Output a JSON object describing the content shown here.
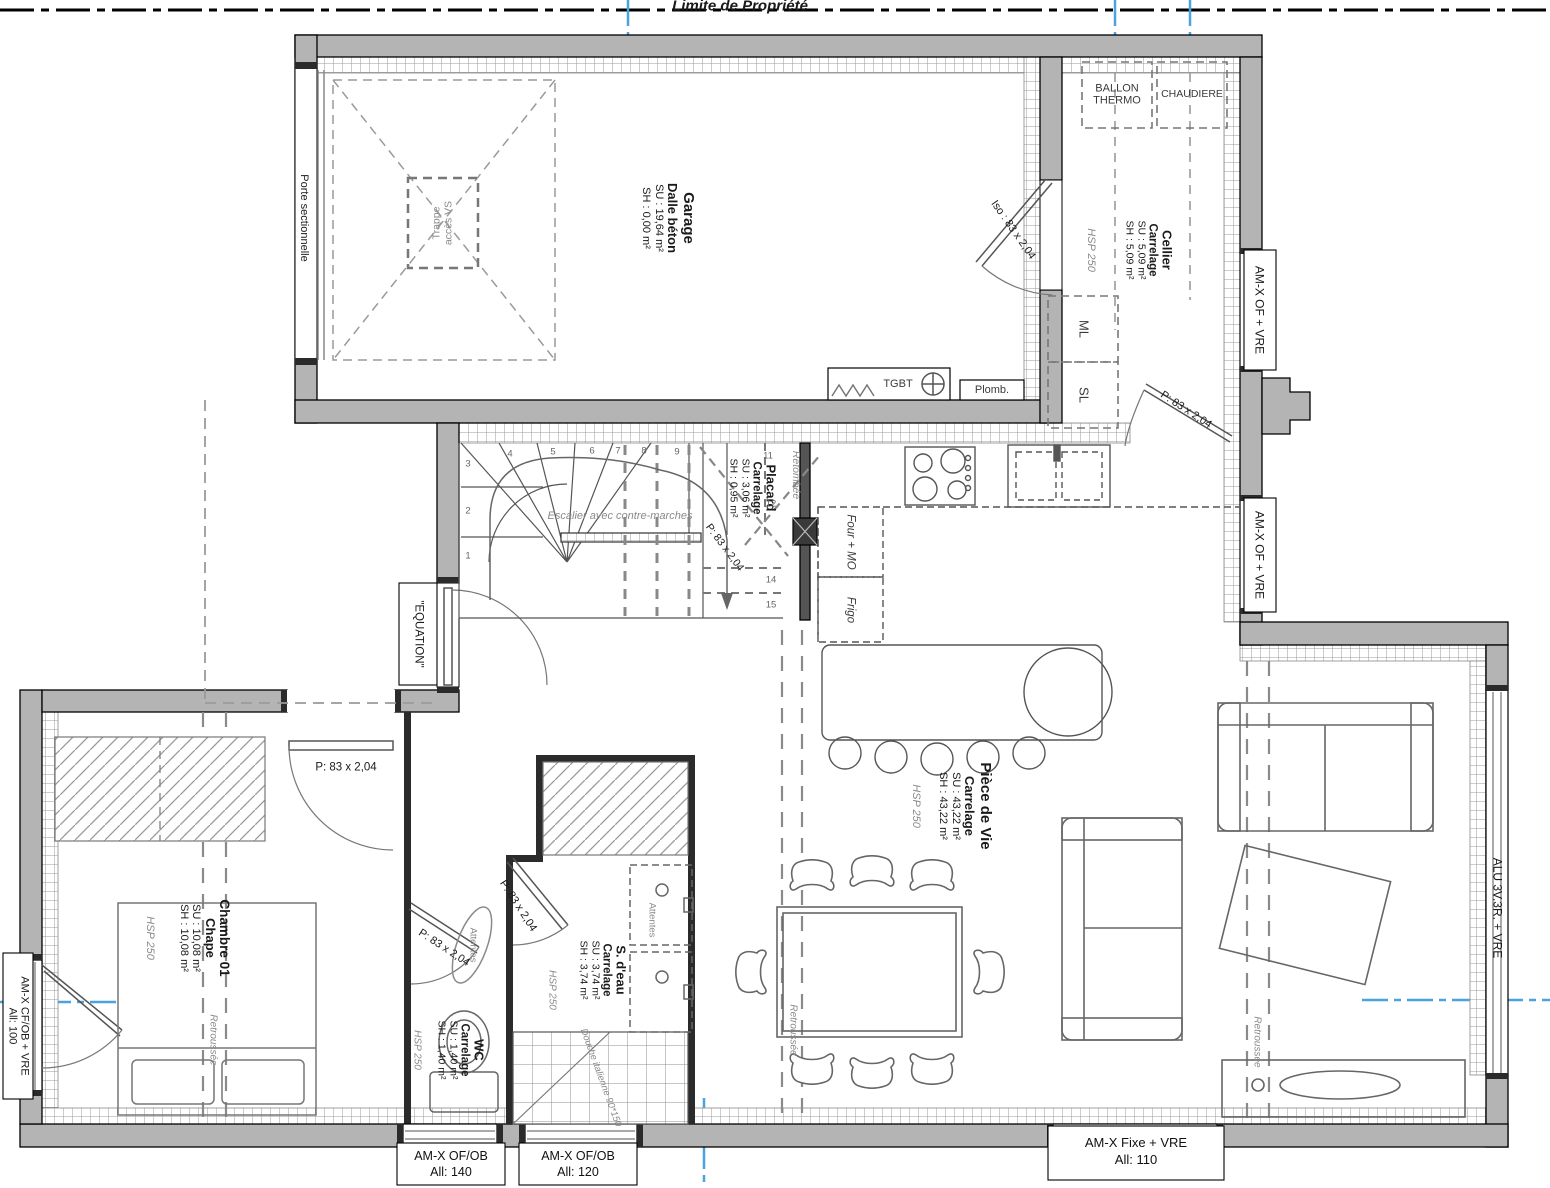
{
  "colors": {
    "wall_gray": "#b4b4b4",
    "line_black": "#1a1a1a",
    "furniture_gray": "#666666",
    "annotation_gray": "#8a8a8a",
    "axis_blue": "#4aa3df"
  },
  "property_line_label": "Limite de Propriété",
  "rooms": {
    "garage": {
      "name": "Garage",
      "floor": "Dalle béton",
      "su": "SU : 19,64 m²",
      "sh": "SH : 0,00 m²"
    },
    "cellier": {
      "name": "Cellier",
      "floor": "Carrelage",
      "su": "SU : 5,09 m²",
      "sh": "SH : 5,09 m²"
    },
    "placard": {
      "name": "Placard",
      "floor": "Carrelage",
      "su": "SU : 3,06 m²",
      "sh": "SH : 0,95 m²"
    },
    "piece_de_vie": {
      "name": "Pièce de Vie",
      "floor": "Carrelage",
      "su": "SU : 43,22 m²",
      "sh": "SH : 43,22 m²"
    },
    "chambre": {
      "name": "Chambre 01",
      "floor": "Chape",
      "su": "SU : 10,08 m²",
      "sh": "SH : 10,08 m²"
    },
    "wc": {
      "name": "WC",
      "floor": "Carrelage",
      "su": "SU : 1,40 m²",
      "sh": "SH : 1,40 m²"
    },
    "sdeau": {
      "name": "S. d'eau",
      "floor": "Carrelage",
      "su": "SU : 3,74 m²",
      "sh": "SH : 3,74 m²"
    }
  },
  "equipment": {
    "ballon_l1": "BALLON",
    "ballon_l2": "THERMO",
    "chaudiere": "CHAUDIERE",
    "ml": "ML",
    "sl": "SL",
    "tgbt": "TGBT",
    "plomb": "Plomb.",
    "four_mo": "Four + MO",
    "frigo": "Frigo"
  },
  "stairs": {
    "label": "Escalier avec contre-marches",
    "numbers": [
      "1",
      "2",
      "3",
      "4",
      "5",
      "6",
      "7",
      "8",
      "9",
      "10",
      "11",
      "12",
      "13",
      "14",
      "15"
    ]
  },
  "doors": {
    "porte_sectionnelle": "Porte sectionnelle",
    "equation": "\"EQUATION\"",
    "p83": "P: 83 x 2,04",
    "iso": "Iso : 83 x 2,04",
    "trappe_l1": "Trappe",
    "trappe_l2": "accès VS"
  },
  "windows": {
    "amx_of_vre": "AM-X OF + VRE",
    "amx_cfob": "AM-X CF/OB + VRE",
    "all_100": "All: 100",
    "amx_ofob": "AM-X OF/OB",
    "all_140": "All: 140",
    "all_120": "All: 120",
    "amx_fixe": "AM-X Fixe + VRE",
    "all_110": "All: 110",
    "alu": "ALU 3V.3R. + VRE"
  },
  "annotations": {
    "retombee": "Retombée",
    "retroussee": "Retroussée",
    "hsp": "HSP 250",
    "attentes": "Attentes",
    "douche": "Douche italienne 90*150"
  }
}
